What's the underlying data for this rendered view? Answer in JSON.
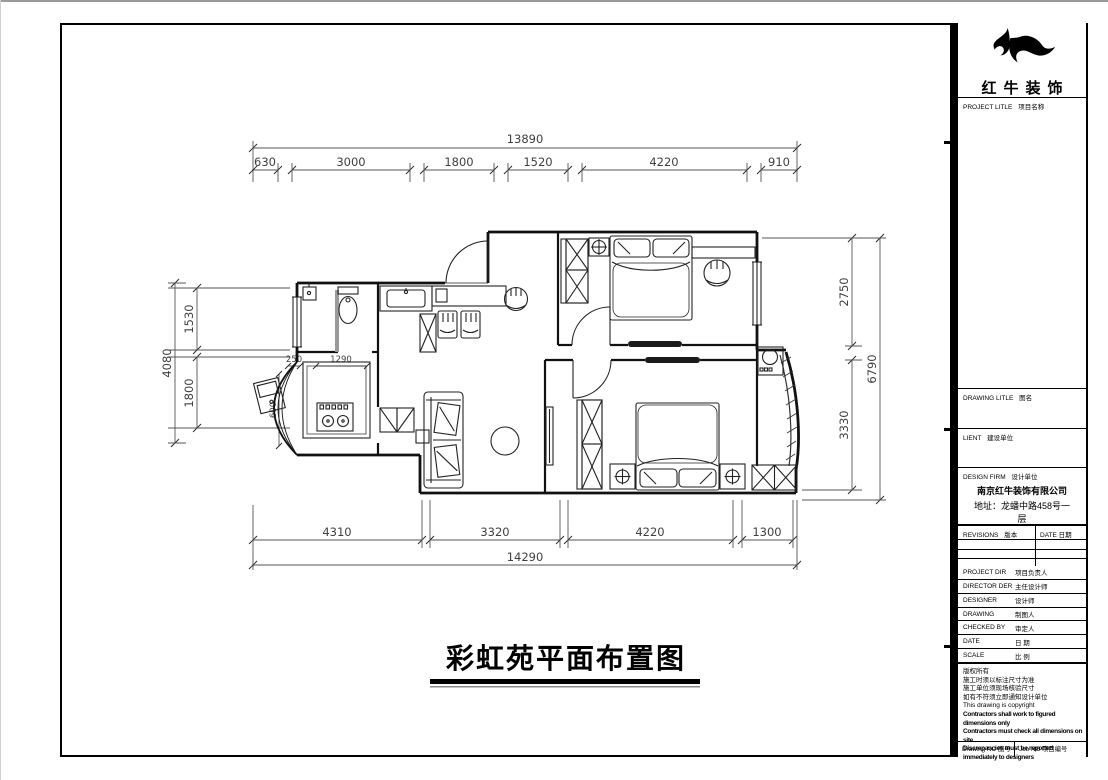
{
  "drawing_title": "彩虹苑平面布置图",
  "dims": {
    "top_overall": "13890",
    "top_segments": [
      "630",
      "3000",
      "1800",
      "1520",
      "4220",
      "910"
    ],
    "bottom_segments": [
      "4310",
      "3320",
      "4220",
      "1300"
    ],
    "bottom_overall": "14290",
    "left_overall": "4080",
    "left_segments": [
      "1530",
      "1800"
    ],
    "right_segments": [
      "2750",
      "3330"
    ],
    "right_overall": "6790",
    "inner": {
      "offset": "250",
      "counter": "1290",
      "depth": "600"
    }
  },
  "title_block": {
    "brand_name": "红牛装饰",
    "sections": {
      "project": {
        "en": "PROJECT LITLE",
        "cn": "项目名称"
      },
      "drawing": {
        "en": "DRAWING LITLE",
        "cn": "图名"
      },
      "client": {
        "en": "LIENT",
        "cn": "建设单位"
      },
      "design_firm": {
        "en": "DESIGN FIRM",
        "cn": "设计单位"
      }
    },
    "company_name": "南京红牛装饰有限公司",
    "company_address_line1": "地址：龙蟠中路458号一",
    "company_address_line2": "层",
    "revisions": {
      "en": "REVISIONS",
      "cn": "版本"
    },
    "revisions_date": {
      "en": "DATE",
      "cn": "日期"
    },
    "staff_rows": [
      {
        "en": "PROJECT DIR",
        "cn": "项目负责人"
      },
      {
        "en": "DIRECTOR DER",
        "cn": "主任设计师"
      },
      {
        "en": "DESIGNER",
        "cn": "设计师"
      },
      {
        "en": "DRAWING",
        "cn": "制图人"
      },
      {
        "en": "CHECKED BY",
        "cn": "审定人"
      },
      {
        "en": "DATE",
        "cn": "日 期"
      },
      {
        "en": "SCALE",
        "cn": "比 例"
      }
    ],
    "notes": [
      "版权所有",
      "施工时须以标注尺寸为准",
      "施工单位须现场核验尺寸",
      "如有不符须立即通知设计单位",
      "This drawing is copyright",
      "Contractors shall work to figured dimensions only",
      "Contractors must check all dimensions on site",
      "Discrepancies must be reported immediately to designers"
    ],
    "footer": {
      "drawing_no": {
        "en": "Drawing NO",
        "cn": "图号"
      },
      "job_no": {
        "en": "Job NO",
        "cn": "项目编号"
      }
    }
  }
}
